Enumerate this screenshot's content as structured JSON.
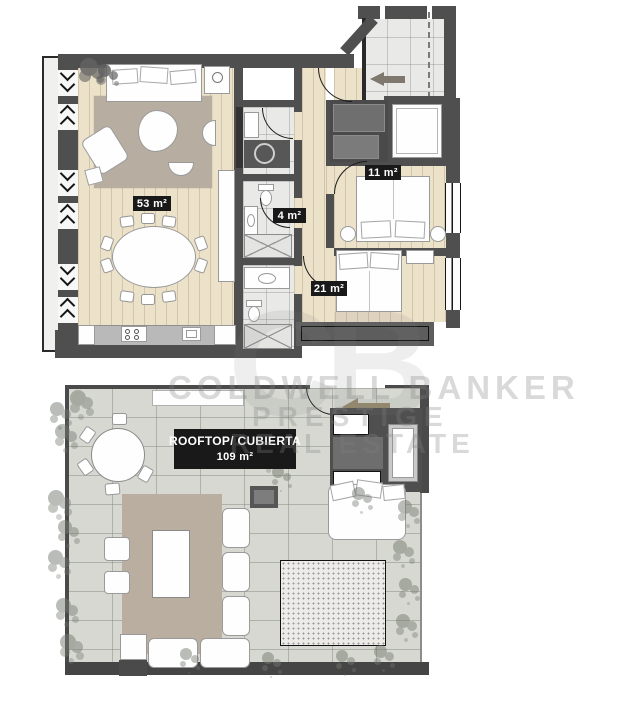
{
  "upper_plan": {
    "living_room_area": "53 m²",
    "bathroom_area": "4 m²",
    "bedroom_1_area": "11 m²",
    "bedroom_2_area": "21 m²"
  },
  "rooftop_plan": {
    "title": "ROOFTOP/ CUBIERTA",
    "area": "109 m²"
  },
  "watermark": {
    "brand_line": "COLDWELL BANKER",
    "sub_line1": "PRESTIGE",
    "sub_line2": "REAL ESTATE",
    "logo_monogram": "CB"
  },
  "icons": {
    "entrance_arrow": "left-arrow",
    "rooftop_entrance_arrow": "left-arrow"
  },
  "colors": {
    "wall": "#4f4f4f",
    "wood_floor": "#ece1c9",
    "tile_floor": "#e9e9e7",
    "rooftop_tile": "#d6d8d1",
    "deck": "#b9ae9f",
    "rug": "#b7aea1",
    "label_bg": "#191919",
    "label_text": "#ffffff",
    "entry_arrow": "#7e786e",
    "rooftop_arrow": "#97896c"
  }
}
